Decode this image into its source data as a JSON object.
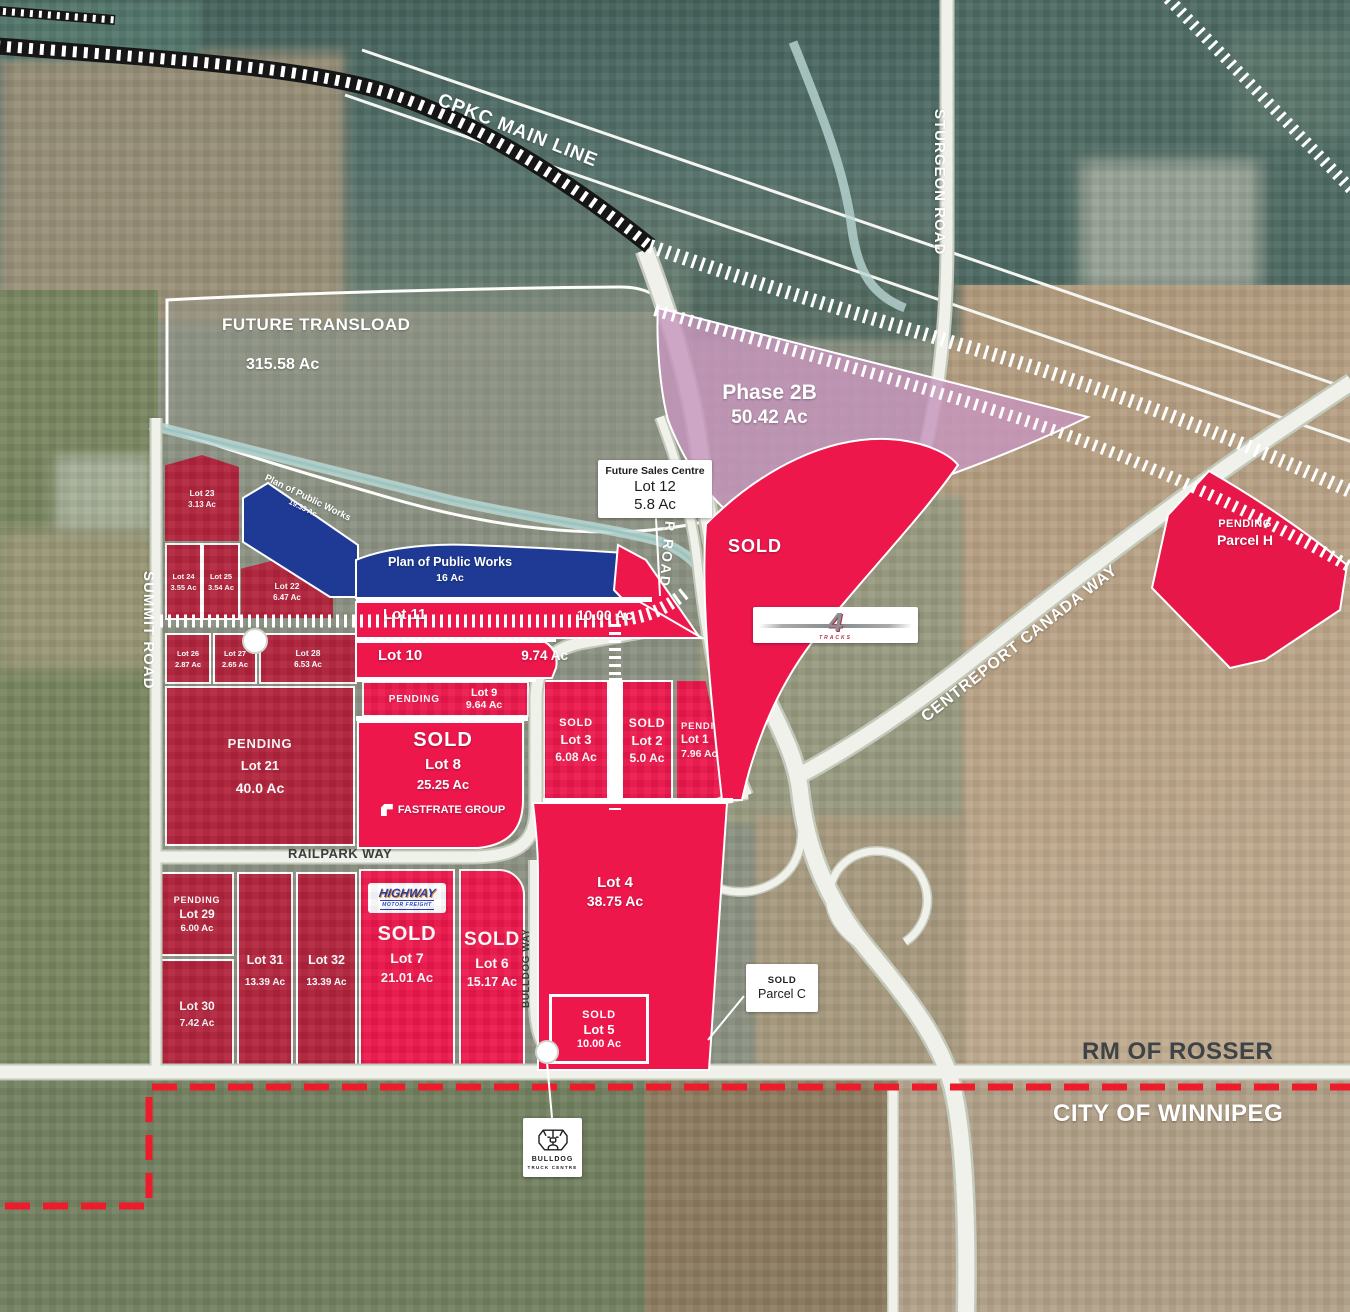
{
  "colors": {
    "sold_red": "#ED174C",
    "pending_red": "#B2233C",
    "public_works_blue": "#1E3A94",
    "phase_pink": "#C795BD",
    "boundary_dash_red": "#EC1C2C"
  },
  "region": {
    "rm_label": "RM OF ROSSER",
    "city_label": "CITY OF WINNIPEG"
  },
  "roads": {
    "cpkc": "CPKC MAIN LINE",
    "sturgeon": "STURGEON ROAD",
    "summit": "SUMMIT ROAD",
    "rosser": "ROSSER ROAD",
    "centreport": "CENTREPORT CANADA WAY",
    "railpark": "RAILPARK WAY",
    "bulldog": "BULLDOG WAY"
  },
  "areas": {
    "future_transload": {
      "name": "FUTURE TRANSLOAD",
      "acres": "315.58 Ac"
    },
    "phase_2b": {
      "name": "Phase 2B",
      "acres": "50.42 Ac"
    },
    "public_works_small": {
      "name": "Plan of Public Works",
      "acres": "19.33 Ac"
    },
    "public_works_main": {
      "name": "Plan of Public Works",
      "acres": "16 Ac"
    },
    "sold_area_label": "SOLD"
  },
  "boxes": {
    "sales_centre": {
      "title": "Future Sales Centre",
      "lot": "Lot 12",
      "acres": "5.8 Ac"
    },
    "parcel_c": {
      "status": "SOLD",
      "name": "Parcel C"
    }
  },
  "parcel_h": {
    "status": "PENDING",
    "name": "Parcel H"
  },
  "lots": {
    "lot23": {
      "name": "Lot 23",
      "acres": "3.13 Ac"
    },
    "lot24": {
      "name": "Lot 24",
      "acres": "3.55 Ac"
    },
    "lot25": {
      "name": "Lot 25",
      "acres": "3.54 Ac"
    },
    "lot22": {
      "name": "Lot 22",
      "acres": "6.47 Ac"
    },
    "lot26": {
      "name": "Lot 26",
      "acres": "2.87 Ac"
    },
    "lot27": {
      "name": "Lot 27",
      "acres": "2.65 Ac"
    },
    "lot28": {
      "name": "Lot 28",
      "acres": "6.53 Ac"
    },
    "lot21": {
      "status": "PENDING",
      "name": "Lot 21",
      "acres": "40.0 Ac"
    },
    "lot11": {
      "name": "Lot 11",
      "acres": "10.00 Ac"
    },
    "lot10": {
      "name": "Lot 10",
      "acres": "9.74 Ac"
    },
    "lot9": {
      "status": "PENDING",
      "name": "Lot 9",
      "acres": "9.64 Ac"
    },
    "lot8": {
      "status": "SOLD",
      "name": "Lot 8",
      "acres": "25.25 Ac"
    },
    "lot3": {
      "status": "SOLD",
      "name": "Lot 3",
      "acres": "6.08 Ac"
    },
    "lot2": {
      "status": "SOLD",
      "name": "Lot 2",
      "acres": "5.0 Ac"
    },
    "lot1": {
      "status": "PENDING",
      "name": "Lot 1",
      "acres": "7.96 Ac"
    },
    "lot4": {
      "name": "Lot 4",
      "acres": "38.75 Ac"
    },
    "lot5": {
      "status": "SOLD",
      "name": "Lot 5",
      "acres": "10.00 Ac"
    },
    "lot29": {
      "status": "PENDING",
      "name": "Lot 29",
      "acres": "6.00 Ac"
    },
    "lot30": {
      "name": "Lot 30",
      "acres": "7.42 Ac"
    },
    "lot31": {
      "name": "Lot 31",
      "acres": "13.39 Ac"
    },
    "lot32": {
      "name": "Lot 32",
      "acres": "13.39 Ac"
    },
    "lot7": {
      "status": "SOLD",
      "name": "Lot 7",
      "acres": "21.01 Ac"
    },
    "lot6": {
      "status": "SOLD",
      "name": "Lot 6",
      "acres": "15.17 Ac"
    }
  },
  "logos": {
    "fastfrate": {
      "text": "FASTFRATE GROUP"
    },
    "highway": {
      "line1": "HIGHWAY",
      "line2": "MOTOR FREIGHT"
    },
    "bulldog": {
      "line1": "BULLDOG",
      "line2": "TRUCK CENTRE"
    },
    "four_tracks": {
      "numeral": "4",
      "text": "TRACKS"
    }
  }
}
